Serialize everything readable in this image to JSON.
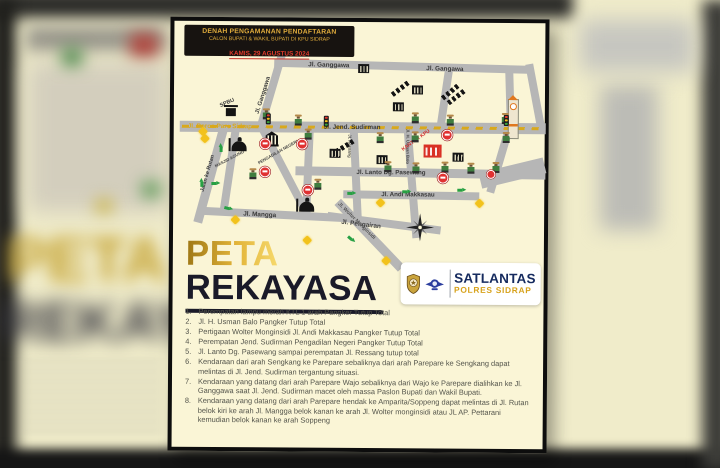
{
  "header": {
    "line1": "DENAH PENGAMANAN PENDAFTARAN",
    "line2": "CALON BUPATI & WAKIL BUPATI DI KPU SIDRAP",
    "line3": "KAMIS, 29 AGUSTUS 2024"
  },
  "title": {
    "line1": "PETA",
    "line2": "REKAYASA"
  },
  "branding": {
    "unit": "SATLANTAS",
    "subunit": "POLRES SIDRAP"
  },
  "map": {
    "road_labels": {
      "ganggawa_top": "Jl. Ganggawa",
      "gangawa_top_right": "Jl. Gangawa",
      "ganggawa_diagonal": "Jl. Ganggawa",
      "poros_pare_sidrap": "Jl. Poros Pare Sidrap",
      "jend_sudirman": "Jl. Jend. Sudirman",
      "lanto_dg_pasewang": "Jl. Lanto Dg. Pasewang",
      "andi_makkasau": "Jl. Andi Makkasau",
      "mangga": "Jl. Mangga",
      "pengairan": "Jl. Pengairan",
      "jalan_ke_rutan": "Jalan ke Rutan",
      "wolter_monginsidi": "Jl. Wolter Monginsidi",
      "ressang": "Jl. Ressang",
      "usman_balo": "Jl. H. Usman Balo"
    },
    "landmark_labels": {
      "spbu": "SPBU",
      "kantor_kpu": "KANTOR KPU",
      "masjid_agung": "MASJID AGUNG",
      "pengadilan_negeri": "PENGADILAN NEGERI"
    }
  },
  "list": {
    "items": [
      "Perempatan lampu merah KTL 1 arah Pangker Tutup Total",
      "Jl. H. Usman Balo Pangker Tutup Total",
      "Pertigaan Wolter Monginsidi Jl. Andi Makkasau Pangker Tutup Total",
      "Perempatan Jend. Sudirman Pengadilan Negeri Pangker Tutup Total",
      "Jl. Lanto Dg. Pasewang sampai perempatan Jl. Ressang tutup total",
      "Kendaraan dari arah Sengkang ke Parepare sebaliknya dari arah Parepare ke Sengkang dapat melintas di Jl. Jend. Sudirman tergantung situasi.",
      "Kendaraan yang datang dari arah Parepare Wajo sebaliknya dari Wajo ke Parepare dialihkan ke Jl. Ganggawa saat Jl. Jend. Sudirman macet oleh massa Paslon Bupati dan Wakil Bupati.",
      "Kendaraan yang datang dari arah Parepare hendak ke Amparita/Soppeng dapat melintas di Jl. Rutan belok kiri ke arah Jl. Mangga belok kanan ke arah Jl. Wolter monginsidi atau JL AP. Pettarani kemudian belok kanan ke arah Soppeng"
    ]
  },
  "colors": {
    "accent_gold": "#d9a91c",
    "alert_red": "#d93025",
    "brand_navy": "#152a5e",
    "road_gray": "#b6b6b6",
    "poster_cream": "#faf5d6"
  }
}
